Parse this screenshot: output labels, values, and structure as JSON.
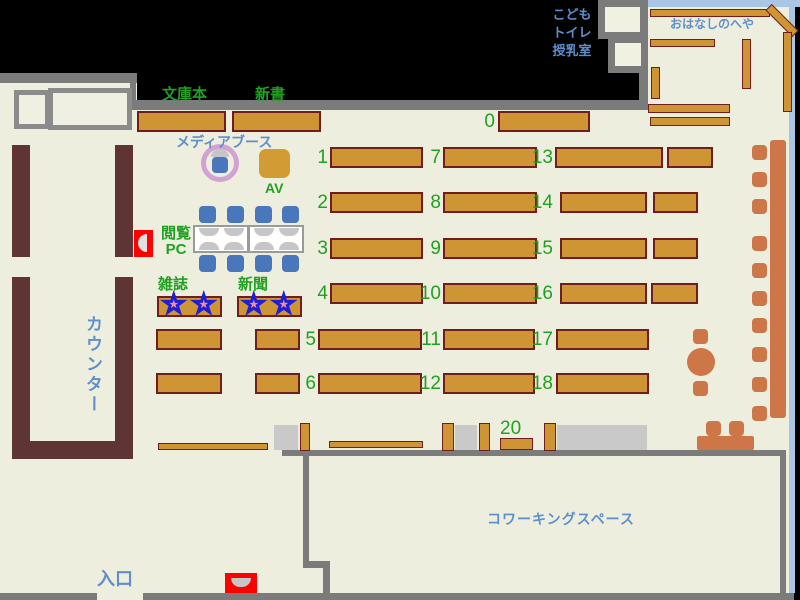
{
  "labels": {
    "bunkobon": "文庫本",
    "shinsho": "新書",
    "media_booth": "メディアブース",
    "av": "AV",
    "reading_pc_line1": "閲覧",
    "reading_pc_line2": "PC",
    "magazines": "雑誌",
    "newspapers": "新聞",
    "counter": "カウンター",
    "entrance": "入口",
    "coworking": "コワーキングスペース",
    "kids": "こども",
    "toilet": "トイレ",
    "nursing_room": "授乳室",
    "story_room": "おはなしのへや"
  },
  "shelves": {
    "numbers": [
      "0",
      "1",
      "2",
      "3",
      "4",
      "5",
      "6",
      "7",
      "8",
      "9",
      "10",
      "11",
      "12",
      "13",
      "14",
      "15",
      "16",
      "17",
      "18",
      "20"
    ]
  },
  "icons": {
    "star": "★"
  },
  "colors": {
    "floor": "#eeeede",
    "wall_gray": "#7b7b7b",
    "shelf_fill": "#cf9434",
    "shelf_border": "#6f1d1d",
    "counter_brown": "#5f3434",
    "furniture_salmon": "#cd7647",
    "chair_blue": "#4a76bb",
    "label_green": "#21a121",
    "label_blue": "#5f8fcb",
    "story_room_border": "#a9c6e4",
    "gate_red": "#ff0000",
    "media_ring_pink": "#d2a2d4",
    "star_blue_outline": "#1e1ed8",
    "star_pink": "#f49090"
  }
}
